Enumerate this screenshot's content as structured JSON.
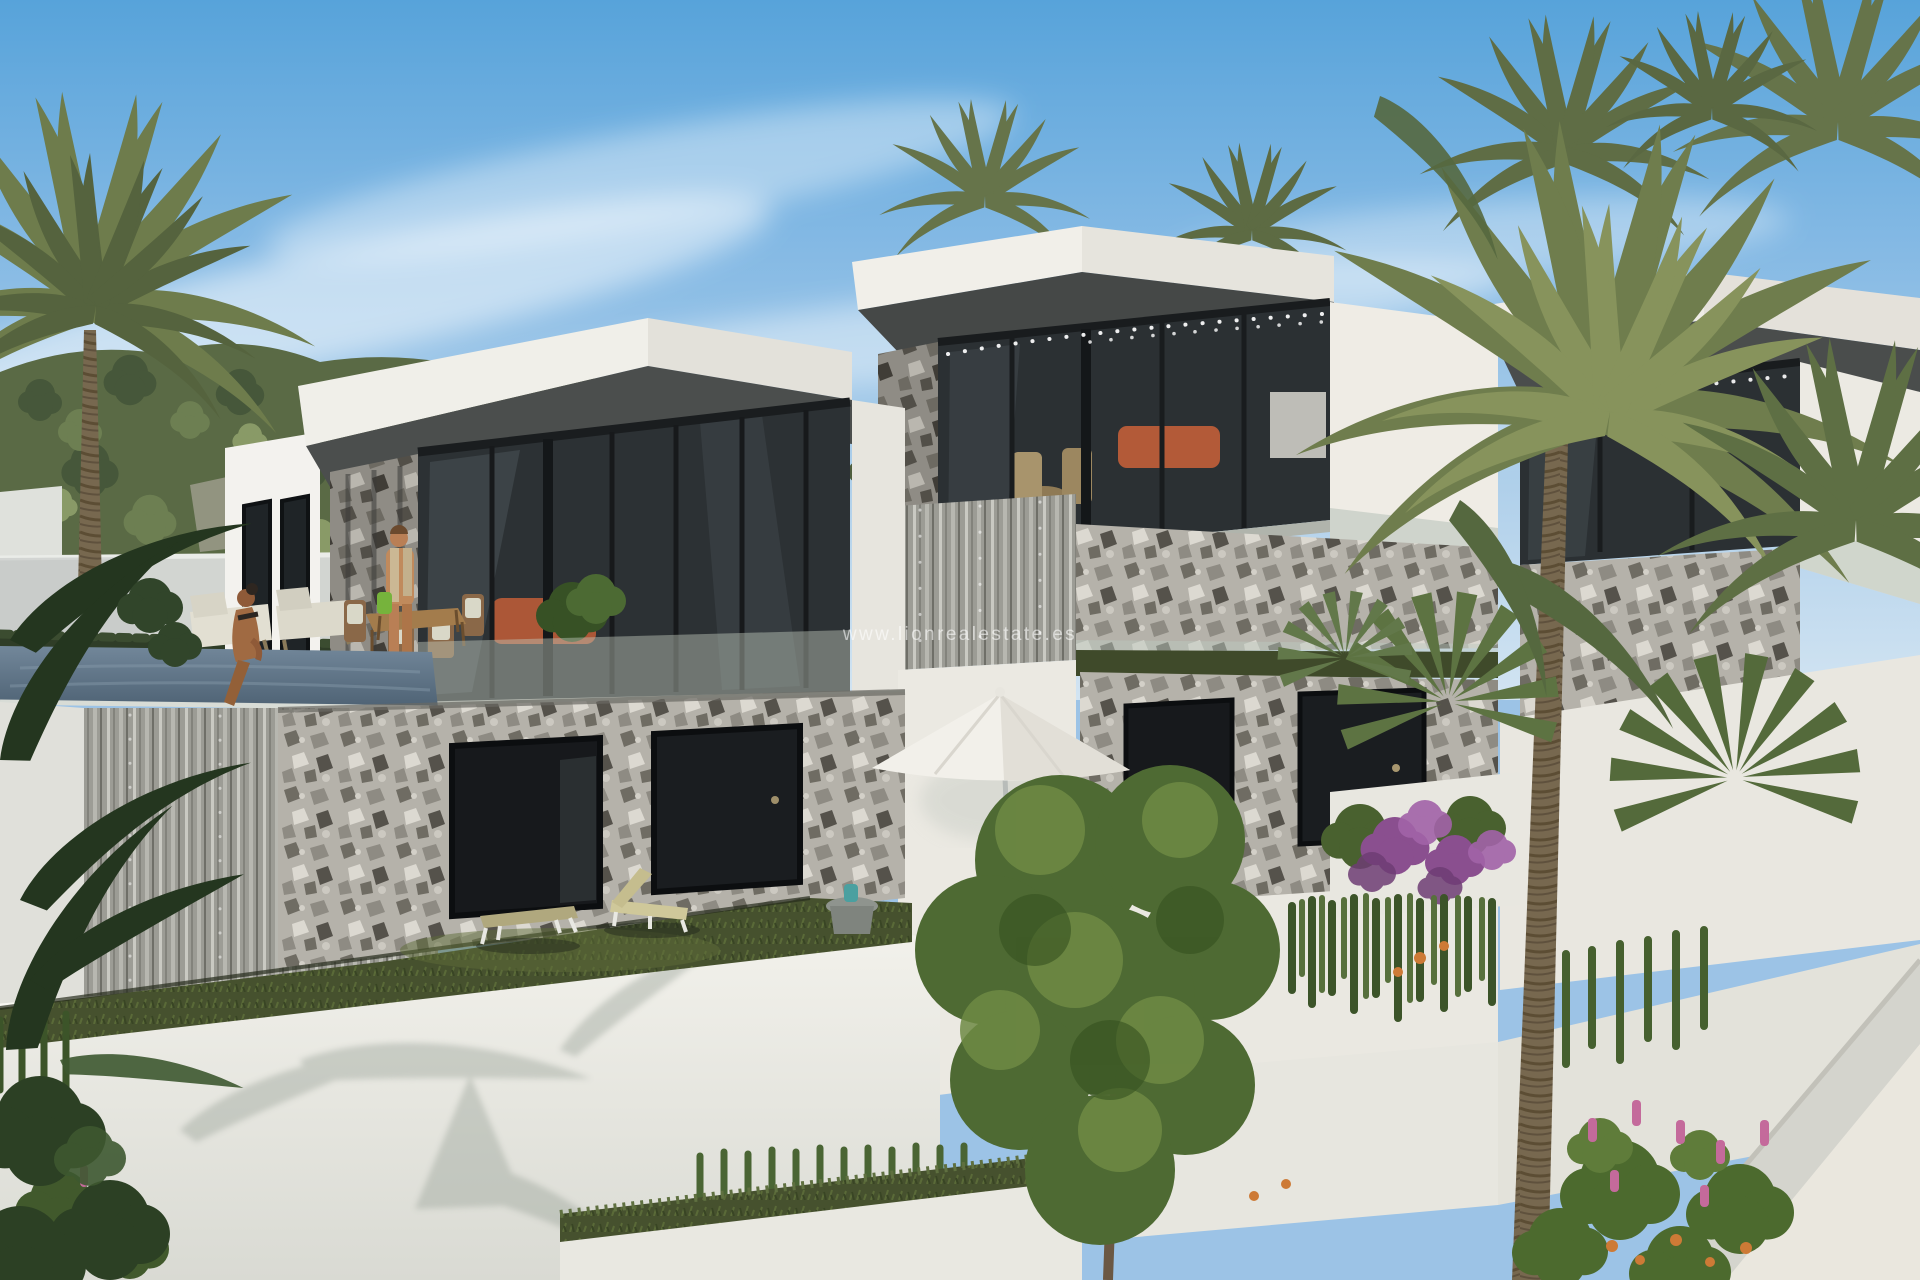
{
  "watermark": {
    "text": "www.lionrealestate.es",
    "color": "#ffffff",
    "opacity": 0.58
  },
  "scene": {
    "description": "3D architectural rendering of three modern white flat-roof villas on a terraced hillside with infinity pool, palm trees, lush gardens and two people",
    "villas_count": 3,
    "people": [
      "standing-man-on-terrace",
      "woman-sitting-at-pool-edge"
    ],
    "elements": [
      "sky",
      "clouds",
      "pine-hillside",
      "left-palm-tree",
      "boundary-wall",
      "infinity-pool",
      "pool-waterfall-edge",
      "villa-terrace-dining-set",
      "terrace-loungers",
      "stone-facade",
      "basement-windows",
      "lawn-sun-loungers",
      "side-table",
      "white-parasol",
      "roof-palms",
      "string-lights",
      "terracotta-sofas",
      "right-palm-cluster",
      "fan-palms",
      "ficus-tree",
      "bougainvillea",
      "ivy-cascades",
      "flower-shrubs",
      "terraced-white-walls",
      "ramp-wall"
    ]
  },
  "palette": {
    "sky_top": "#57a3da",
    "sky_low": "#cfe2f1",
    "cloud": "#e9f2f9",
    "hill_green": "#5a6a45",
    "villa_white": "#f1efe9",
    "villa_shade": "#e3e1da",
    "soffit_gray": "#474a49",
    "glass_dark": "#2b3033",
    "stone_base": "#b5b2aa",
    "stone_dark": "#98958d",
    "waterfall_silver": "#9c9c95",
    "pool_water": "#5f7689",
    "lawn_green": "#46512e",
    "foliage_dark": "#33492b",
    "foliage_mid": "#5d7540",
    "palm_olive": "#6f7d4d",
    "bougainvillea_purple": "#8a4f8f",
    "flower_pink": "#c46a9b",
    "flower_orange": "#cd7a36",
    "wall_white": "#eceade",
    "sofa_terracotta": "#b35a38",
    "skin_tan": "#b97f55",
    "wood_brown": "#8a6b46"
  }
}
